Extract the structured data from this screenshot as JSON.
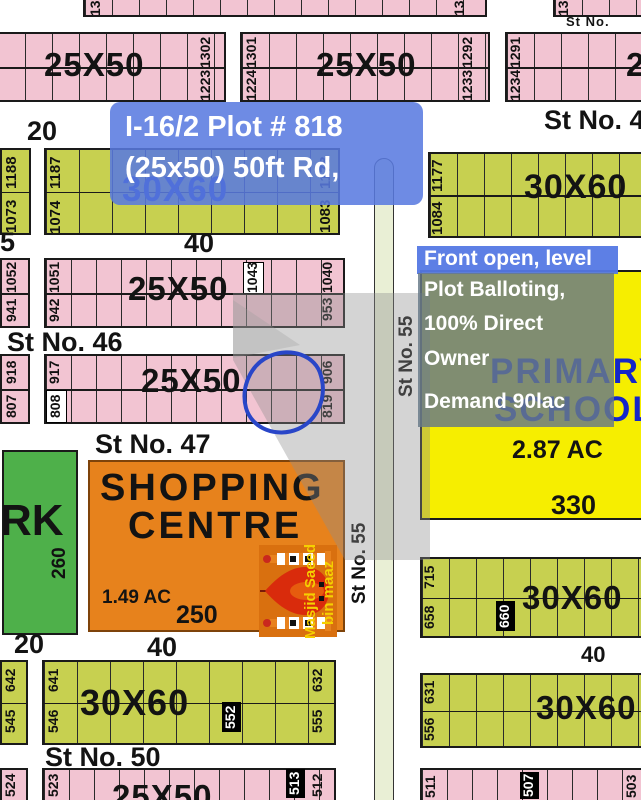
{
  "title_overlay": {
    "line1": "I-16/2 Plot # 818",
    "line2": "(25x50) 50ft Rd,"
  },
  "note": {
    "header": "Front open, level",
    "line2": "Plot Balloting,",
    "line3": "100% Direct",
    "line4": "Owner",
    "demand": "Demand 90lac"
  },
  "streets": {
    "top_small": "St No.",
    "top_right": "St No. 4",
    "st46": "St No. 46",
    "st47": "St No. 47",
    "st50": "St No. 50",
    "st55_upper": "St No. 55",
    "st55_lower": "St No. 55"
  },
  "size_labels": {
    "r1a": "25X50",
    "r1b": "25X50",
    "r1c": "25X50",
    "r2_left": "30X60",
    "r2_right": "30X60",
    "r3": "25X50",
    "r4": "25X50",
    "r6l": "30X60",
    "r6ra": "30X60",
    "r6rb": "30X60",
    "bl_strip": "25X50"
  },
  "width_labels": {
    "w20_top": "20",
    "w40_top": "40",
    "w5_left": "5",
    "w20_bottom": "20",
    "w40_bottom": "40",
    "w40_right": "40"
  },
  "park": {
    "name": "RK",
    "num": "260"
  },
  "shopping": {
    "line1": "SHOPPING",
    "line2": "CENTRE",
    "area": "1.49 AC",
    "num": "250"
  },
  "school": {
    "line1": "PRIMARY",
    "line2": "SCHOOL",
    "area": "2.87 AC",
    "num": "330"
  },
  "mosque": {
    "line1": "Masjid Saeed",
    "line2": "bin maaz"
  },
  "plots": [
    "13",
    "13",
    "13",
    "1302",
    "1223",
    "1301",
    "1224",
    "1292",
    "1233",
    "1291",
    "1234",
    "1188",
    "1073",
    "1187",
    "1074",
    "1178",
    "1083",
    "1177",
    "1084",
    "1052",
    "941",
    "1051",
    "942",
    "1043",
    "1040",
    "953",
    "918",
    "807",
    "917",
    "808",
    "906",
    "819",
    "715",
    "658",
    "660",
    "631",
    "556",
    "642",
    "545",
    "641",
    "546",
    "552",
    "632",
    "555",
    "524",
    "523",
    "513",
    "512",
    "511",
    "507",
    "503"
  ],
  "colors": {
    "plot_pink": "#f2c4d2",
    "plot_olive": "#c7d050",
    "park_green": "#4eb04a",
    "shopping_orange": "#e7821c",
    "school_yellow": "#f6ee00",
    "overlay_blue": "#5a7be0",
    "map_text_blue": "#1b33b4",
    "road_fill": "#e9efd5",
    "annotation_circle": "#2946c8"
  }
}
